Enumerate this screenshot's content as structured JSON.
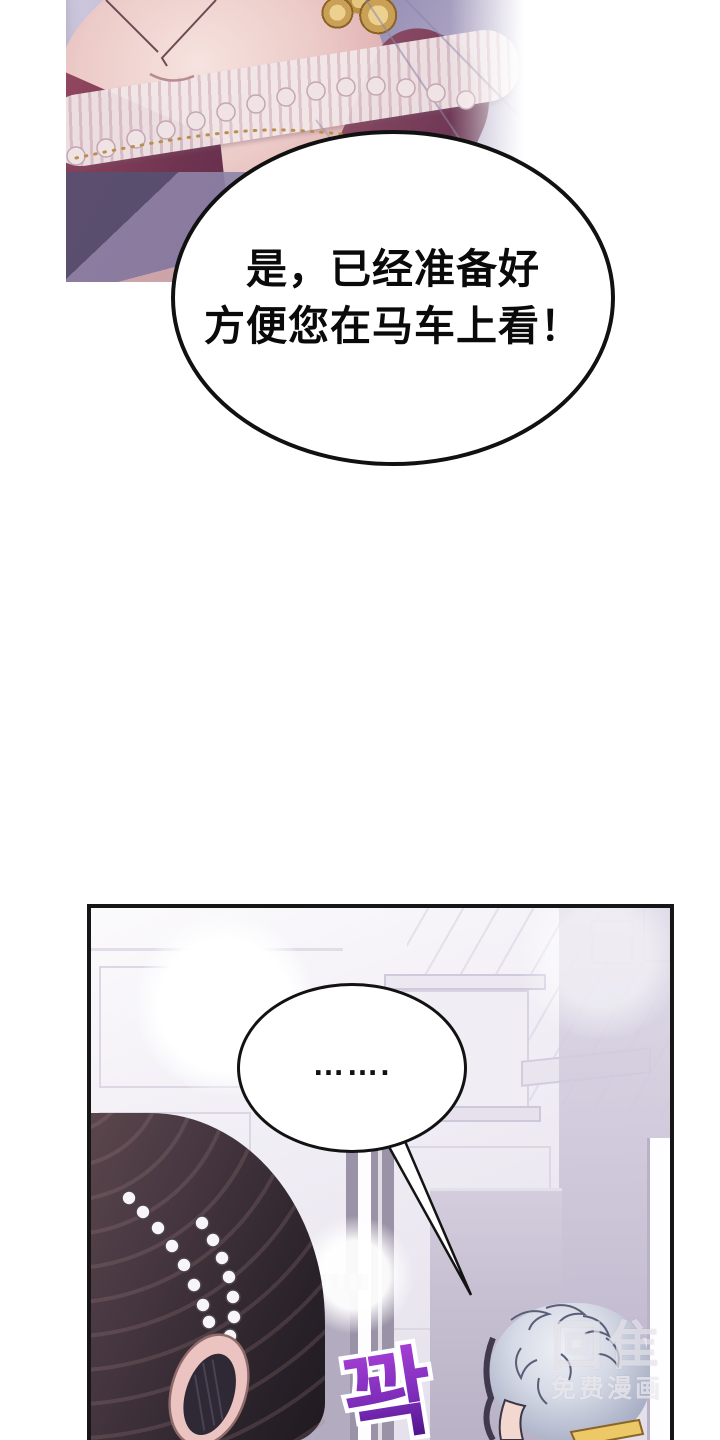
{
  "page": {
    "width": 720,
    "height": 1440,
    "background": "#ffffff"
  },
  "top_panel": {
    "speech_bubble": {
      "line1": "是，已经准备好",
      "line2": "方便您在马车上看！",
      "fill": "#ffffff",
      "stroke": "#111111",
      "text_color": "#0a0a0a"
    },
    "art": {
      "fabric_color": "#aca4c3",
      "skin_color": "#eac6c4",
      "lace_color": "#f0e3e5",
      "dress_color": "#8a4560",
      "gold_color": "#cfa75f",
      "shadow_color": "#4c4468"
    }
  },
  "bottom_panel": {
    "border_color": "#161616",
    "speech_bubble": {
      "text": "…….",
      "fill": "#ffffff",
      "stroke": "#121212"
    },
    "sfx": {
      "text": "꽉",
      "gradient_top": "#a43fd4",
      "gradient_bottom": "#4a1086",
      "outline_color": "#ffffff"
    },
    "watermark": {
      "logo": "回隹",
      "caption": "免费漫画"
    },
    "scene": {
      "wall_color": "#ece8f2",
      "line_color": "#d6d0e1",
      "column_color": "#cac3d7",
      "dresser_color": "#c8c2d4",
      "door_color": "#9a92a6",
      "light_color": "#ffffff",
      "hair_color": "#32282e",
      "pearl_color": "#f7f5f7",
      "ear_skin": "#ebc4c1",
      "silver_hair": "#ccd2e0",
      "collar_gold": "#ecc867"
    }
  }
}
